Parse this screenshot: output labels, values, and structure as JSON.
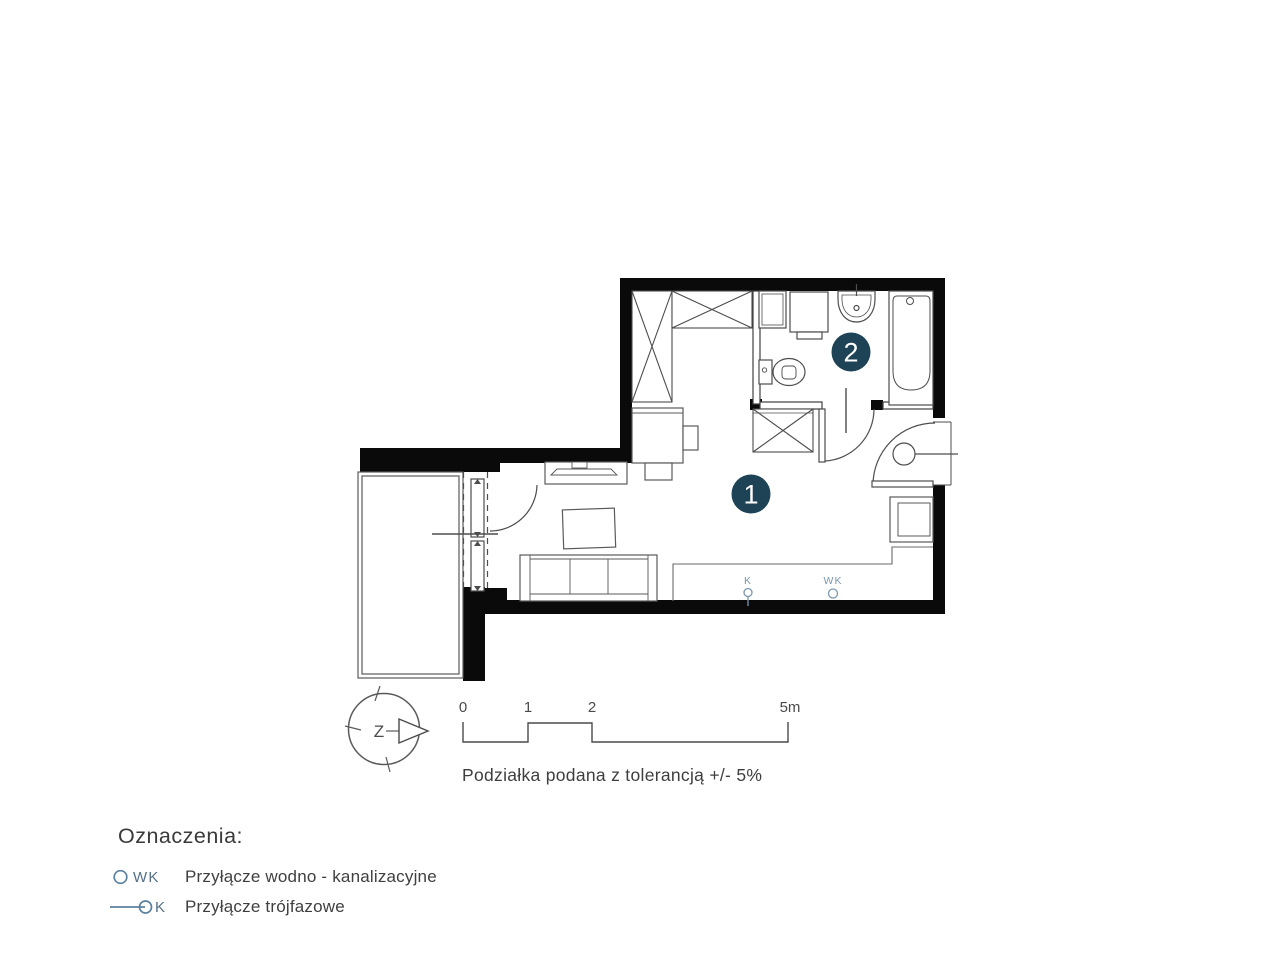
{
  "plan": {
    "room_markers": [
      {
        "label": "1"
      },
      {
        "label": "2"
      }
    ],
    "utility_points": {
      "k": "K",
      "wk": "WK"
    },
    "colors": {
      "wall": "#0a0a0a",
      "line": "#4d4d4d",
      "marker": "#1f4356",
      "utility_blue": "#7b97b0",
      "legend_blue": "#5d81a0",
      "text_gray": "#3e3e3e"
    }
  },
  "compass": {
    "west_label": "Z"
  },
  "scale_bar": {
    "ticks": [
      "0",
      "1",
      "2",
      "5m"
    ],
    "caption": "Podziałka podana z tolerancją +/- 5%"
  },
  "legend": {
    "title": "Oznaczenia:",
    "items": [
      {
        "code": "WK",
        "description": "Przyłącze wodno - kanalizacyjne"
      },
      {
        "code": "K",
        "description": "Przyłącze trójfazowe"
      }
    ]
  }
}
